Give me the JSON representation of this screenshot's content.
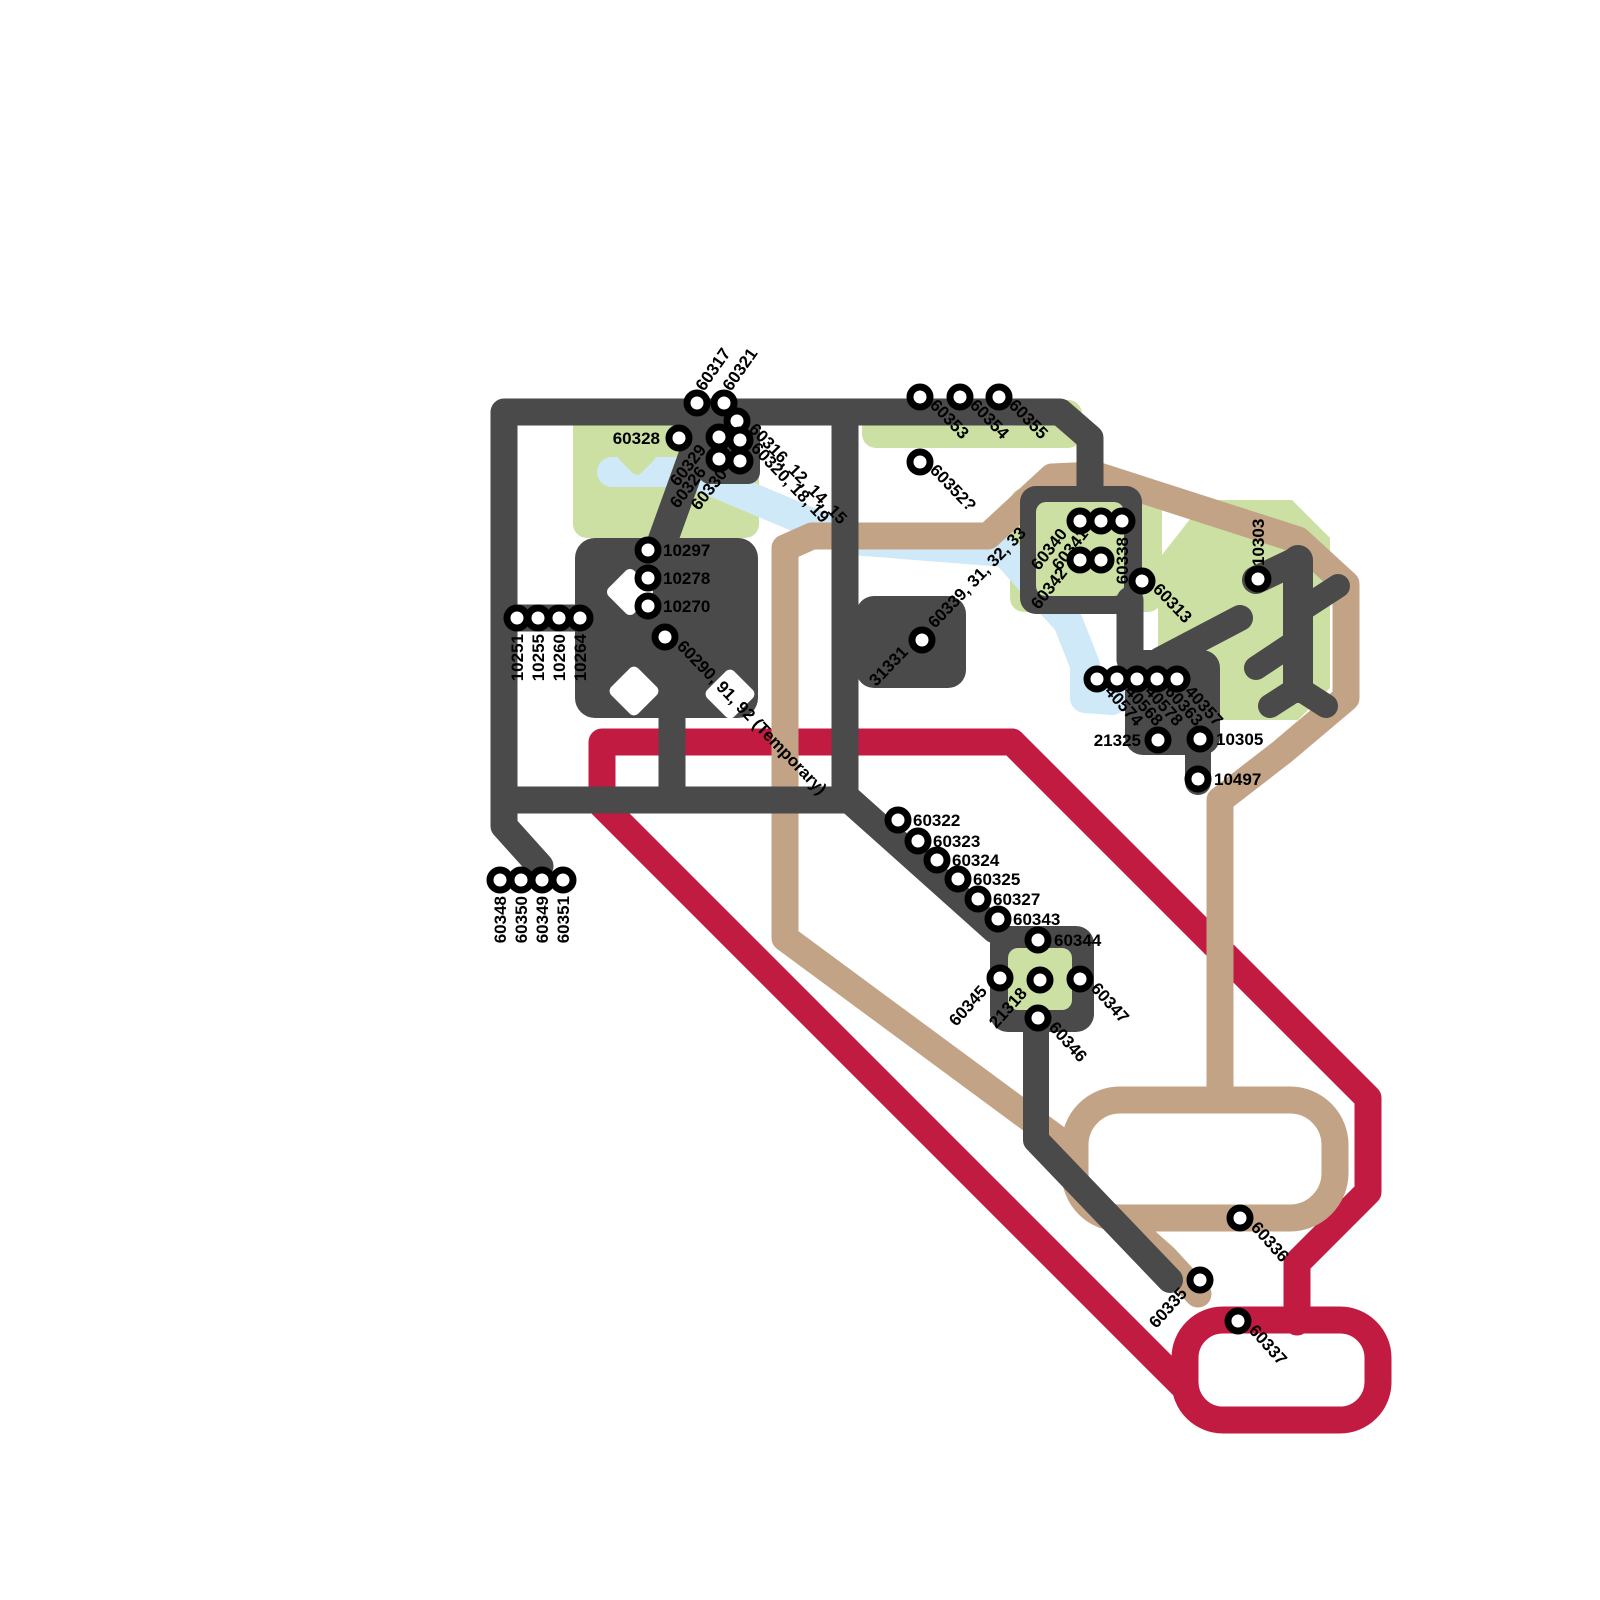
{
  "map": {
    "colors": {
      "dark": "#4a4a4a",
      "red": "#c21b41",
      "tan": "#c2a386",
      "water": "#cfe9f8",
      "park": "#cbe0a2",
      "station_ring": "#000000",
      "station_fill": "#ffffff",
      "label": "#000000",
      "background": "#ffffff"
    },
    "routes": [
      {
        "name": "dark-network",
        "color_key": "dark"
      },
      {
        "name": "red-loop",
        "color_key": "red"
      },
      {
        "name": "tan-loop",
        "color_key": "tan"
      },
      {
        "name": "waterway",
        "color_key": "water"
      },
      {
        "name": "park-areas",
        "color_key": "park"
      }
    ],
    "stations": [
      {
        "id": "60317",
        "cx": 697,
        "cy": 403,
        "labels": [
          {
            "t": "60317",
            "x": 704,
            "y": 392,
            "r": -55,
            "a": "start"
          }
        ]
      },
      {
        "id": "60321",
        "cx": 724,
        "cy": 403,
        "labels": [
          {
            "t": "60321",
            "x": 731,
            "y": 392,
            "r": -55,
            "a": "start"
          }
        ]
      },
      {
        "id": "60328",
        "cx": 679,
        "cy": 438,
        "labels": [
          {
            "t": "60328",
            "x": 660,
            "y": 444,
            "r": 0,
            "a": "end"
          }
        ]
      },
      {
        "id": "60316-12-14-15",
        "cx": 737,
        "cy": 421,
        "labels": [
          {
            "t": "60316, 12, 14, 15",
            "x": 748,
            "y": 430,
            "r": 46,
            "a": "start"
          }
        ]
      },
      {
        "id": "60320-18-19",
        "cx": 740,
        "cy": 440,
        "labels": [
          {
            "t": "60320, 18, 19",
            "x": 750,
            "y": 449,
            "r": 46,
            "a": "start"
          }
        ]
      },
      {
        "id": "60329",
        "cx": 719,
        "cy": 437,
        "labels": [
          {
            "t": "60329",
            "x": 707,
            "y": 450,
            "r": -52,
            "a": "end"
          }
        ]
      },
      {
        "id": "60326",
        "cx": 719,
        "cy": 459,
        "labels": [
          {
            "t": "60326",
            "x": 707,
            "y": 472,
            "r": -52,
            "a": "end"
          }
        ]
      },
      {
        "id": "60330",
        "cx": 740,
        "cy": 461,
        "labels": [
          {
            "t": "60330",
            "x": 728,
            "y": 474,
            "r": -52,
            "a": "end"
          }
        ]
      },
      {
        "id": "60353",
        "cx": 920,
        "cy": 397,
        "labels": [
          {
            "t": "60353",
            "x": 929,
            "y": 406,
            "r": 46,
            "a": "start"
          }
        ]
      },
      {
        "id": "60354",
        "cx": 960,
        "cy": 397,
        "labels": [
          {
            "t": "60354",
            "x": 969,
            "y": 406,
            "r": 46,
            "a": "start"
          }
        ]
      },
      {
        "id": "60355",
        "cx": 999,
        "cy": 397,
        "labels": [
          {
            "t": "60355",
            "x": 1008,
            "y": 406,
            "r": 46,
            "a": "start"
          }
        ]
      },
      {
        "id": "60352",
        "cx": 920,
        "cy": 462,
        "labels": [
          {
            "t": "60352?",
            "x": 929,
            "y": 471,
            "r": 46,
            "a": "start"
          }
        ]
      },
      {
        "id": "10297",
        "cx": 648,
        "cy": 550,
        "labels": [
          {
            "t": "10297",
            "x": 663,
            "y": 556,
            "r": 0,
            "a": "start"
          }
        ]
      },
      {
        "id": "10278",
        "cx": 648,
        "cy": 578,
        "labels": [
          {
            "t": "10278",
            "x": 663,
            "y": 584,
            "r": 0,
            "a": "start"
          }
        ]
      },
      {
        "id": "10270",
        "cx": 648,
        "cy": 606,
        "labels": [
          {
            "t": "10270",
            "x": 663,
            "y": 612,
            "r": 0,
            "a": "start"
          }
        ]
      },
      {
        "id": "10251",
        "cx": 517,
        "cy": 618,
        "labels": [
          {
            "t": "10251",
            "x": 523,
            "y": 634,
            "r": -90,
            "a": "end"
          }
        ]
      },
      {
        "id": "10255",
        "cx": 538,
        "cy": 618,
        "labels": [
          {
            "t": "10255",
            "x": 544,
            "y": 634,
            "r": -90,
            "a": "end"
          }
        ]
      },
      {
        "id": "10260",
        "cx": 559,
        "cy": 618,
        "labels": [
          {
            "t": "10260",
            "x": 565,
            "y": 634,
            "r": -90,
            "a": "end"
          }
        ]
      },
      {
        "id": "10264",
        "cx": 580,
        "cy": 618,
        "labels": [
          {
            "t": "10264",
            "x": 586,
            "y": 634,
            "r": -90,
            "a": "end"
          }
        ]
      },
      {
        "id": "60290-91-92",
        "cx": 665,
        "cy": 637,
        "labels": [
          {
            "t": "60290, 91, 92 (Temporary)",
            "x": 676,
            "y": 647,
            "r": 46,
            "a": "start"
          }
        ]
      },
      {
        "id": "31331",
        "cx": 922,
        "cy": 640,
        "labels": [
          {
            "t": "31331",
            "x": 909,
            "y": 653,
            "r": -46,
            "a": "end"
          },
          {
            "t": "60339, 31, 32, 33",
            "x": 935,
            "y": 629,
            "r": -46,
            "a": "start"
          }
        ]
      },
      {
        "id": "60340",
        "cx": 1080,
        "cy": 521,
        "labels": [
          {
            "t": "60340",
            "x": 1068,
            "y": 534,
            "r": -52,
            "a": "end"
          }
        ]
      },
      {
        "id": "60341",
        "cx": 1101,
        "cy": 521,
        "labels": [
          {
            "t": "60341",
            "x": 1089,
            "y": 534,
            "r": -52,
            "a": "end"
          }
        ]
      },
      {
        "id": "60338",
        "cx": 1122,
        "cy": 521,
        "labels": [
          {
            "t": "60338",
            "x": 1128,
            "y": 537,
            "r": -90,
            "a": "end"
          }
        ]
      },
      {
        "id": "60342",
        "cx": 1080,
        "cy": 560,
        "labels": [
          {
            "t": "60342",
            "x": 1068,
            "y": 573,
            "r": -52,
            "a": "end"
          }
        ]
      },
      {
        "id": "60342b",
        "cx": 1101,
        "cy": 560,
        "labels": []
      },
      {
        "id": "60313",
        "cx": 1142,
        "cy": 581,
        "labels": [
          {
            "t": "60313",
            "x": 1152,
            "y": 590,
            "r": 46,
            "a": "start"
          }
        ]
      },
      {
        "id": "10303",
        "cx": 1258,
        "cy": 579,
        "labels": [
          {
            "t": "10303",
            "x": 1264,
            "y": 566,
            "r": -90,
            "a": "start"
          }
        ]
      },
      {
        "id": "40574",
        "cx": 1097,
        "cy": 679,
        "labels": [
          {
            "t": "40574",
            "x": 1104,
            "y": 692,
            "r": 48,
            "a": "start"
          }
        ]
      },
      {
        "id": "40568",
        "cx": 1117,
        "cy": 679,
        "labels": [
          {
            "t": "40568",
            "x": 1124,
            "y": 692,
            "r": 48,
            "a": "start"
          }
        ]
      },
      {
        "id": "40578",
        "cx": 1137,
        "cy": 679,
        "labels": [
          {
            "t": "40578",
            "x": 1144,
            "y": 692,
            "r": 48,
            "a": "start"
          }
        ]
      },
      {
        "id": "60363",
        "cx": 1157,
        "cy": 679,
        "labels": [
          {
            "t": "60363",
            "x": 1164,
            "y": 692,
            "r": 48,
            "a": "start"
          }
        ]
      },
      {
        "id": "40357",
        "cx": 1177,
        "cy": 679,
        "labels": [
          {
            "t": "40357",
            "x": 1184,
            "y": 692,
            "r": 48,
            "a": "start"
          }
        ]
      },
      {
        "id": "21325",
        "cx": 1158,
        "cy": 740,
        "labels": [
          {
            "t": "21325",
            "x": 1141,
            "y": 746,
            "r": 0,
            "a": "end"
          }
        ]
      },
      {
        "id": "10305",
        "cx": 1200,
        "cy": 739,
        "labels": [
          {
            "t": "10305",
            "x": 1216,
            "y": 745,
            "r": 0,
            "a": "start"
          }
        ]
      },
      {
        "id": "10497",
        "cx": 1198,
        "cy": 779,
        "labels": [
          {
            "t": "10497",
            "x": 1214,
            "y": 785,
            "r": 0,
            "a": "start"
          }
        ]
      },
      {
        "id": "60322",
        "cx": 898,
        "cy": 820,
        "labels": [
          {
            "t": "60322",
            "x": 913,
            "y": 826,
            "r": 0,
            "a": "start"
          }
        ]
      },
      {
        "id": "60323",
        "cx": 918,
        "cy": 841,
        "labels": [
          {
            "t": "60323",
            "x": 933,
            "y": 847,
            "r": 0,
            "a": "start"
          }
        ]
      },
      {
        "id": "60324",
        "cx": 937,
        "cy": 860,
        "labels": [
          {
            "t": "60324",
            "x": 952,
            "y": 866,
            "r": 0,
            "a": "start"
          }
        ]
      },
      {
        "id": "60325",
        "cx": 958,
        "cy": 879,
        "labels": [
          {
            "t": "60325",
            "x": 973,
            "y": 885,
            "r": 0,
            "a": "start"
          }
        ]
      },
      {
        "id": "60327",
        "cx": 978,
        "cy": 899,
        "labels": [
          {
            "t": "60327",
            "x": 993,
            "y": 905,
            "r": 0,
            "a": "start"
          }
        ]
      },
      {
        "id": "60343",
        "cx": 998,
        "cy": 919,
        "labels": [
          {
            "t": "60343",
            "x": 1013,
            "y": 925,
            "r": 0,
            "a": "start"
          }
        ]
      },
      {
        "id": "60344",
        "cx": 1038,
        "cy": 940,
        "labels": [
          {
            "t": "60344",
            "x": 1054,
            "y": 946,
            "r": 0,
            "a": "start"
          }
        ]
      },
      {
        "id": "60345",
        "cx": 1000,
        "cy": 978,
        "labels": [
          {
            "t": "60345",
            "x": 988,
            "y": 992,
            "r": -48,
            "a": "end"
          }
        ]
      },
      {
        "id": "21318",
        "cx": 1040,
        "cy": 980,
        "labels": [
          {
            "t": "21318",
            "x": 1028,
            "y": 994,
            "r": -48,
            "a": "end"
          }
        ]
      },
      {
        "id": "60347",
        "cx": 1080,
        "cy": 979,
        "labels": [
          {
            "t": "60347",
            "x": 1090,
            "y": 989,
            "r": 48,
            "a": "start"
          }
        ]
      },
      {
        "id": "60346",
        "cx": 1038,
        "cy": 1018,
        "labels": [
          {
            "t": "60346",
            "x": 1048,
            "y": 1028,
            "r": 48,
            "a": "start"
          }
        ]
      },
      {
        "id": "60336",
        "cx": 1240,
        "cy": 1218,
        "labels": [
          {
            "t": "60336",
            "x": 1250,
            "y": 1228,
            "r": 48,
            "a": "start"
          }
        ]
      },
      {
        "id": "60335",
        "cx": 1200,
        "cy": 1280,
        "labels": [
          {
            "t": "60335",
            "x": 1188,
            "y": 1294,
            "r": -48,
            "a": "end"
          }
        ]
      },
      {
        "id": "60337",
        "cx": 1238,
        "cy": 1321,
        "labels": [
          {
            "t": "60337",
            "x": 1248,
            "y": 1331,
            "r": 48,
            "a": "start"
          }
        ]
      },
      {
        "id": "60348",
        "cx": 500,
        "cy": 880,
        "labels": [
          {
            "t": "60348",
            "x": 506,
            "y": 896,
            "r": -90,
            "a": "end"
          }
        ]
      },
      {
        "id": "60350",
        "cx": 521,
        "cy": 880,
        "labels": [
          {
            "t": "60350",
            "x": 527,
            "y": 896,
            "r": -90,
            "a": "end"
          }
        ]
      },
      {
        "id": "60349",
        "cx": 542,
        "cy": 880,
        "labels": [
          {
            "t": "60349",
            "x": 548,
            "y": 896,
            "r": -90,
            "a": "end"
          }
        ]
      },
      {
        "id": "60351",
        "cx": 563,
        "cy": 880,
        "labels": [
          {
            "t": "60351",
            "x": 569,
            "y": 896,
            "r": -90,
            "a": "end"
          }
        ]
      }
    ]
  }
}
